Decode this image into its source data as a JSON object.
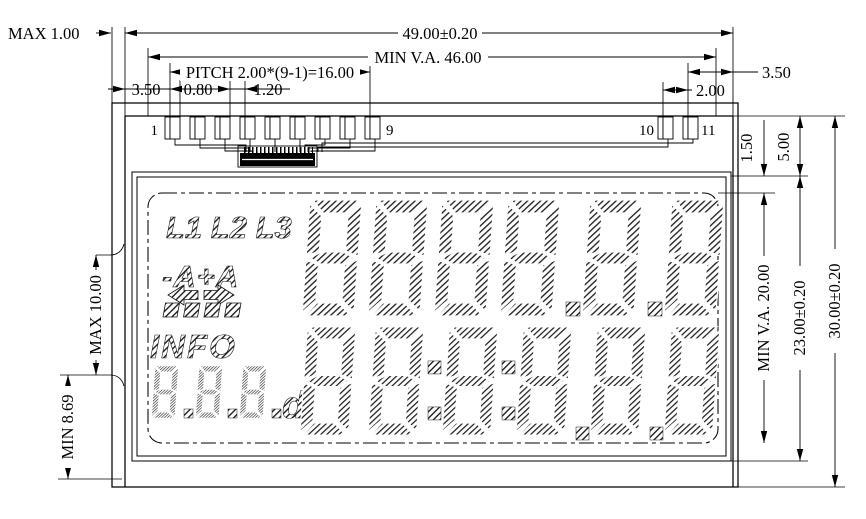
{
  "dimensions": {
    "max_thickness": "MAX 1.00",
    "width": "49.00±0.20",
    "min_va_width": "MIN V.A. 46.00",
    "pitch": "PITCH 2.00*(9-1)=16.00",
    "pad_offset_left": "3.50",
    "pad_width": "0.80",
    "pad_gap": "1.20",
    "pad_offset_right": "3.50",
    "pad_pitch_right": "2.00",
    "ledge_va_gap": "1.50",
    "ledge_height": "5.00",
    "min_va_height": "MIN V.A. 20.00",
    "cell_height": "23.00±0.20",
    "height": "30.00±0.20",
    "digit_height_max": "MAX 10.00",
    "digit_height_min": "MIN 8.69"
  },
  "pins": {
    "p1": "1",
    "p9": "9",
    "p10": "10",
    "p11": "11"
  },
  "lcd": {
    "phase_indicators": "L1 L2 L3",
    "amp_indicators": "-A+A",
    "info_label": "INFO",
    "small_digits": "8.8.8.",
    "small_suffix": "d",
    "top_row": "8888.8.8",
    "bottom_row": "8 8:8:8.8.8"
  }
}
